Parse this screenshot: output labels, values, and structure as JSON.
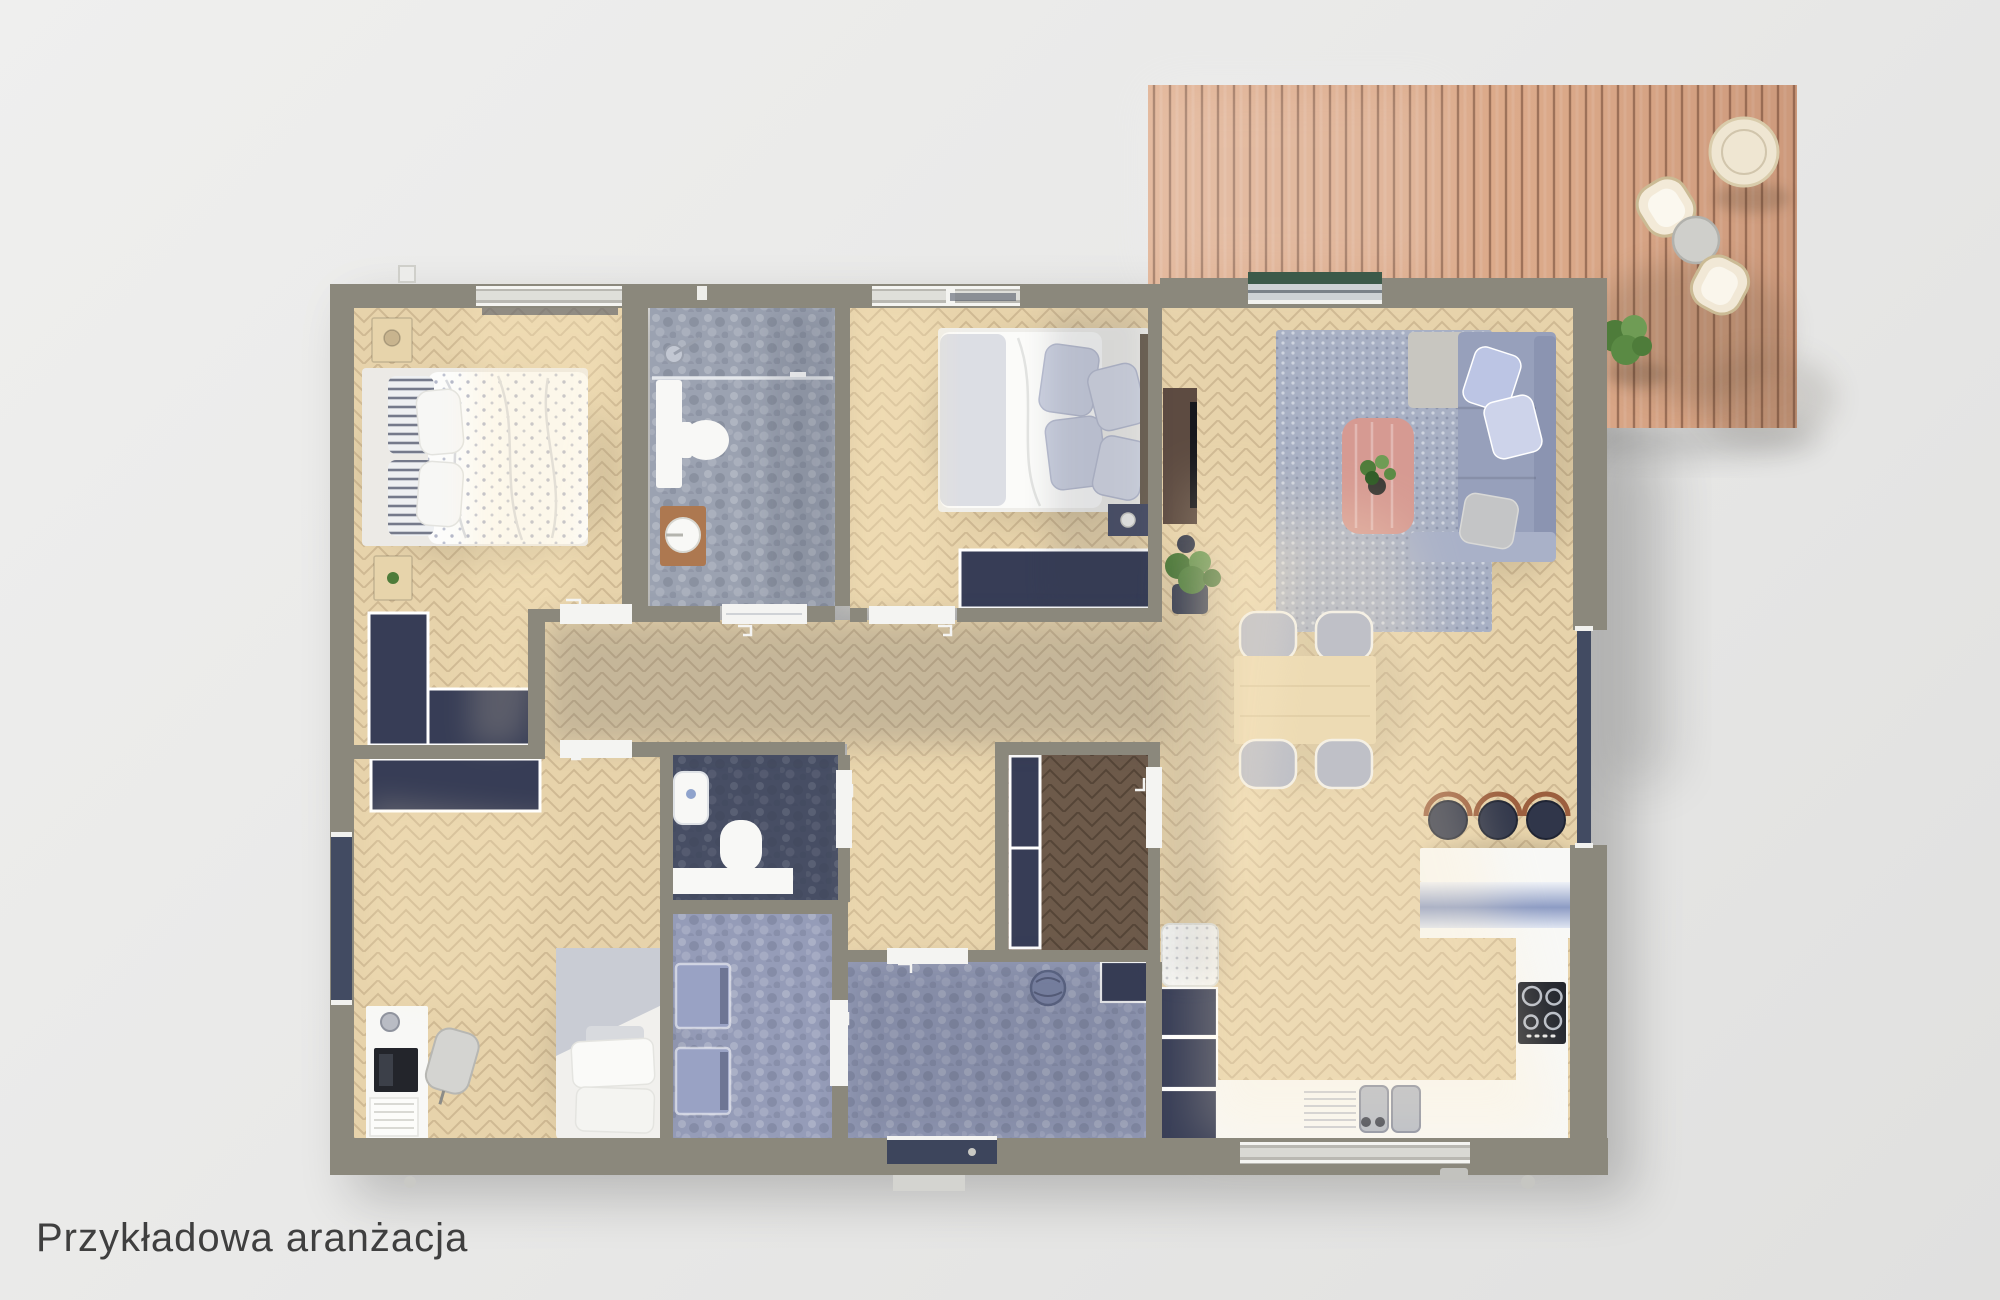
{
  "caption": {
    "text": "Przykładowa aranżacja"
  },
  "colors": {
    "background": "#e9e9e8",
    "caption": "#3f3f3f",
    "wall": "#8b887c",
    "wood": "#e7d3ab",
    "wood_dark": "#6d5a4a",
    "tile_gray": "#9ba2b1",
    "tile_blue": "#959cb8",
    "tile_navy": "#474e64",
    "navy": "#373d56",
    "white": "#f8f8f6",
    "sofa": "#97a0bb",
    "rug": "#a8b0c4",
    "pink": "#d69a92",
    "wood_furn": "#e7d4ab",
    "green": "#4e7c3a",
    "green_mat": "#3c5a49",
    "stool_brown": "#ad7850",
    "terrace": "#dfae8e"
  },
  "scene": {
    "type": "floor-plan-3d-top-view",
    "rooms": [
      {
        "id": "bedroom-main",
        "furniture": [
          "double-bed",
          "nightstand",
          "nightstand",
          "built-in-wardrobe-L"
        ]
      },
      {
        "id": "bathroom",
        "furniture": [
          "walk-in-shower",
          "toilet",
          "vanity",
          "stool-with-basin"
        ]
      },
      {
        "id": "bedroom-second",
        "furniture": [
          "double-bed",
          "nightstand-with-lamp",
          "low-dresser"
        ]
      },
      {
        "id": "office-guest-room",
        "furniture": [
          "desk",
          "laptop",
          "desk-chair",
          "single-bed",
          "wardrobe"
        ]
      },
      {
        "id": "wc",
        "furniture": [
          "washbasin",
          "toilet",
          "counter"
        ]
      },
      {
        "id": "laundry",
        "furniture": [
          "washing-machine",
          "washing-machine"
        ]
      },
      {
        "id": "entrance-hall",
        "furniture": [
          "basket",
          "cabinet"
        ]
      },
      {
        "id": "walk-in-closet",
        "furniture": [
          "wardrobe-unit"
        ]
      },
      {
        "id": "living-kitchen",
        "furniture": [
          "sectional-sofa",
          "area-rug",
          "coffee-table",
          "tv-console",
          "potted-plant",
          "dining-table",
          "dining-chair",
          "dining-chair",
          "dining-chair",
          "dining-chair",
          "kitchen-island",
          "bar-stool",
          "bar-stool",
          "bar-stool",
          "sink-counter",
          "cooktop-counter",
          "tall-cabinets",
          "fluffy-rug"
        ]
      }
    ],
    "terrace": {
      "id": "wood-deck-terrace",
      "furniture": [
        "round-pouf",
        "hanging-chair",
        "side-table",
        "hanging-chair",
        "potted-plant"
      ]
    }
  }
}
